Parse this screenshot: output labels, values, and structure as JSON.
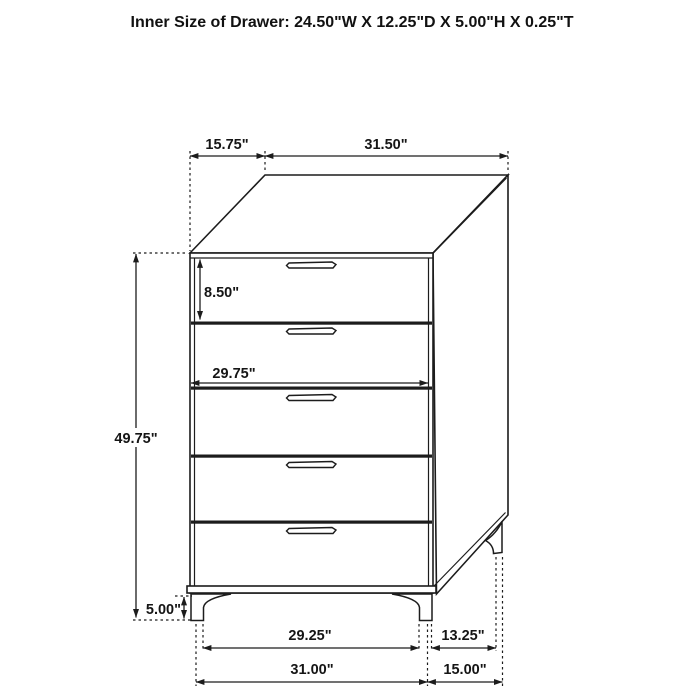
{
  "title": "Inner Size of Drawer: 24.50\"W X 12.25\"D X 5.00\"H X 0.25\"T",
  "labels": {
    "top_depth": "15.75\"",
    "top_width": "31.50\"",
    "top_drawer_height": "8.50\"",
    "drawer_inner_width": "29.75\"",
    "chest_height": "49.75\"",
    "leg_height": "5.00\"",
    "base_front_width": "29.25\"",
    "base_side_depth": "13.25\"",
    "overall_width": "31.00\"",
    "overall_depth": "15.00\""
  },
  "colors": {
    "line": "#1c1c1c",
    "background": "#ffffff"
  }
}
